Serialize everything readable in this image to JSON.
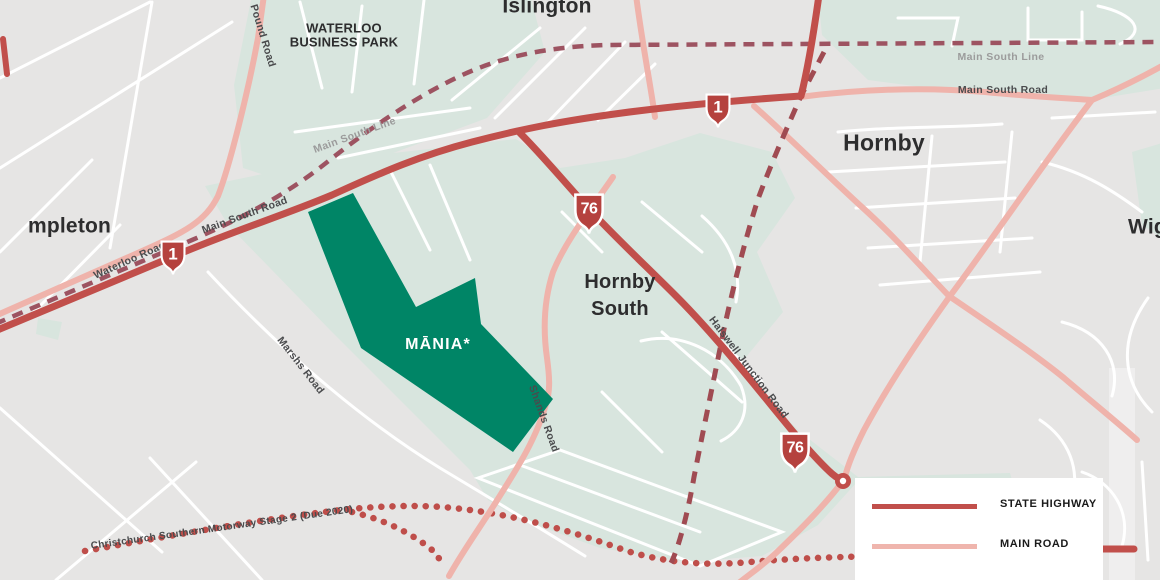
{
  "colors": {
    "background": "#e6e5e4",
    "greenspace": "#d8e5de",
    "minor_road": "#ffffff",
    "main_road": "#efb3ab",
    "state_highway": "#c14f4b",
    "railway": "#9d5361",
    "proposed_route": "#a04b52",
    "motorway_dots": "#bf4e4a",
    "shield_red": "#b5423e",
    "site_green": "#008566",
    "place_label": "#2d2d2e",
    "road_label": "#4a4b4d",
    "rail_label": "#9b9b9b"
  },
  "places": [
    {
      "id": "templeton-partial",
      "text": "mpleton"
    },
    {
      "id": "islington",
      "text": "Islington"
    },
    {
      "id": "waterloo-business-park",
      "line1": "WATERLOO",
      "line2": "BUSINESS PARK"
    },
    {
      "id": "hornby",
      "text": "Hornby"
    },
    {
      "id": "hornby-south",
      "line1": "Hornby",
      "line2": "South"
    },
    {
      "id": "wigram-partial",
      "text": "Wig"
    }
  ],
  "road_labels": [
    {
      "id": "pound-road",
      "text": "Pound Road"
    },
    {
      "id": "main-south-line-west",
      "text": "Main South Line"
    },
    {
      "id": "main-south-line-east",
      "text": "Main South Line"
    },
    {
      "id": "main-south-road-east",
      "text": "Main South Road"
    },
    {
      "id": "main-south-road-west",
      "text": "Main South Road"
    },
    {
      "id": "waterloo-road",
      "text": "Waterloo Road"
    },
    {
      "id": "marshs-road",
      "text": "Marshs Road"
    },
    {
      "id": "shands-road",
      "text": "Shands Road"
    },
    {
      "id": "halswell-junction-road",
      "text": "Halswell Junction Road"
    },
    {
      "id": "southern-motorway",
      "text": "Christchurch Southern Motorway Stage 2 (Due 2020)"
    }
  ],
  "shields": [
    {
      "number": "1"
    },
    {
      "number": "1"
    },
    {
      "number": "76"
    },
    {
      "number": "76"
    }
  ],
  "site": {
    "label": "MĀNIA*"
  },
  "legend": {
    "items": [
      {
        "label": "STATE HIGHWAY",
        "color": "#c14f4b"
      },
      {
        "label": "MAIN ROAD",
        "color": "#efb5ad"
      }
    ]
  }
}
